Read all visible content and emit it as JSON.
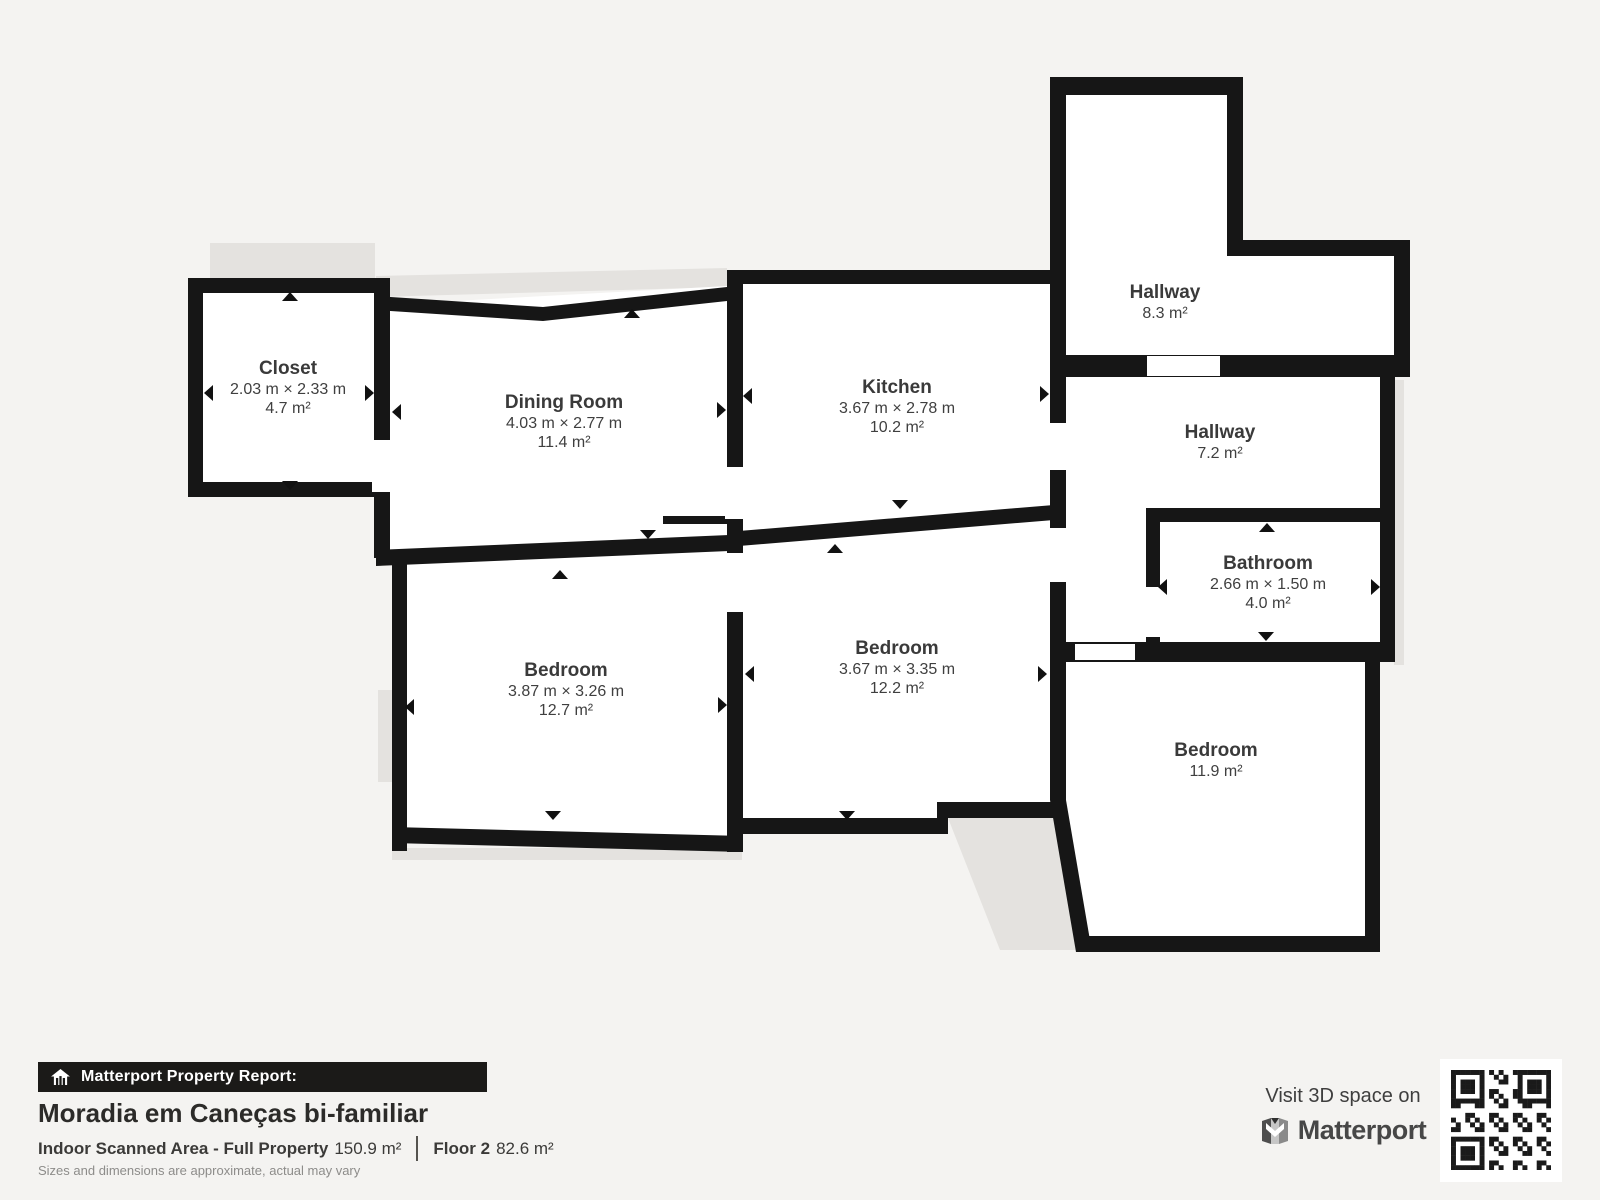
{
  "colors": {
    "background": "#f4f3f1",
    "wall": "#161616",
    "room_fill": "#ffffff",
    "shadow": "#e4e2df",
    "label_text": "#3a3a3a",
    "badge_bar": "#1b1a18"
  },
  "rooms": [
    {
      "id": "closet",
      "name": "Closet",
      "dims": "2.03 m × 2.33 m",
      "area": "4.7 m²"
    },
    {
      "id": "dining-room",
      "name": "Dining Room",
      "dims": "4.03 m × 2.77 m",
      "area": "11.4 m²"
    },
    {
      "id": "kitchen",
      "name": "Kitchen",
      "dims": "3.67 m × 2.78 m",
      "area": "10.2 m²"
    },
    {
      "id": "hallway-upper",
      "name": "Hallway",
      "dims": "",
      "area": "8.3 m²"
    },
    {
      "id": "hallway-lower",
      "name": "Hallway",
      "dims": "",
      "area": "7.2 m²"
    },
    {
      "id": "bathroom",
      "name": "Bathroom",
      "dims": "2.66 m × 1.50 m",
      "area": "4.0 m²"
    },
    {
      "id": "bedroom-left",
      "name": "Bedroom",
      "dims": "3.87 m × 3.26 m",
      "area": "12.7 m²"
    },
    {
      "id": "bedroom-mid",
      "name": "Bedroom",
      "dims": "3.67 m × 3.35 m",
      "area": "12.2 m²"
    },
    {
      "id": "bedroom-right",
      "name": "Bedroom",
      "dims": "",
      "area": "11.9 m²"
    }
  ],
  "report": {
    "badge": "Matterport Property Report:",
    "title": "Moradia em Caneças bi-familiar",
    "scanned_label": "Indoor Scanned Area - Full Property",
    "scanned_value": "150.9 m²",
    "floor_label": "Floor 2",
    "floor_value": "82.6 m²",
    "disclaimer": "Sizes and dimensions are approximate, actual may vary"
  },
  "promo": {
    "visit_text": "Visit 3D space on",
    "brand": "Matterport"
  }
}
